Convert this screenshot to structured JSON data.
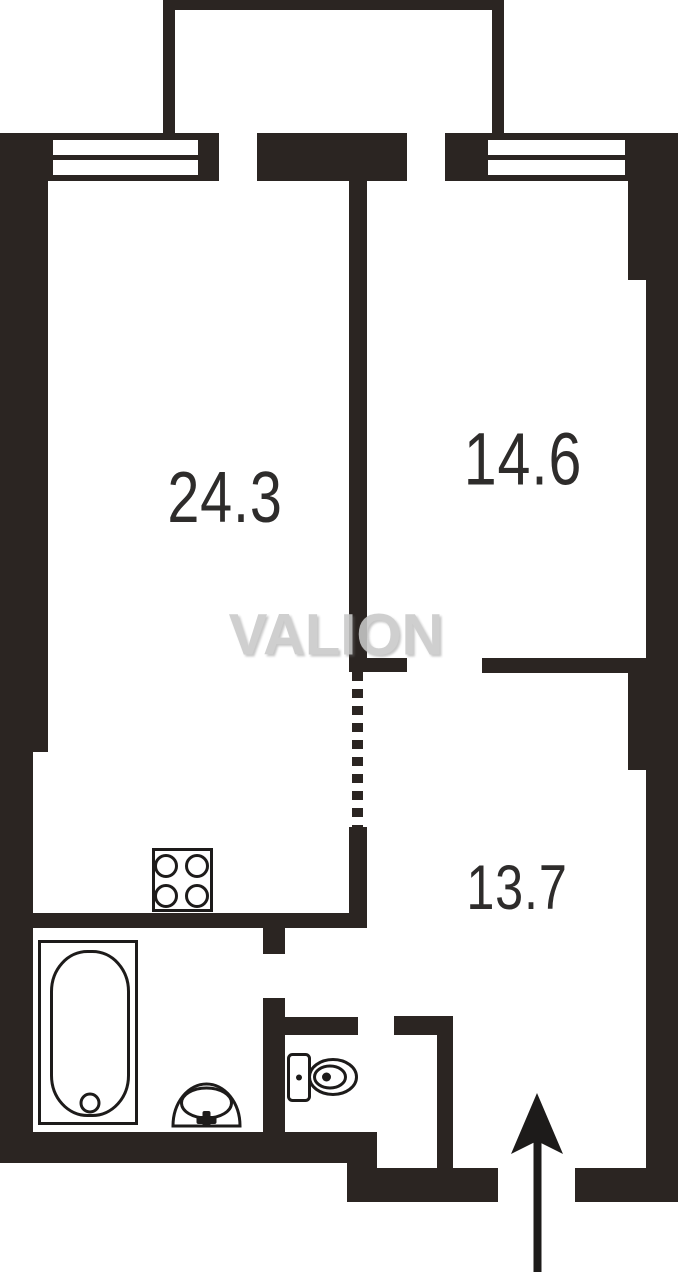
{
  "watermark": {
    "text": "VALION"
  },
  "rooms": [
    {
      "name": "living-room",
      "area": "24.3"
    },
    {
      "name": "bedroom",
      "area": "14.6"
    },
    {
      "name": "hall",
      "area": "13.7"
    }
  ],
  "fixtures": [
    {
      "name": "stove-icon"
    },
    {
      "name": "bathtub-icon"
    },
    {
      "name": "sink-icon"
    },
    {
      "name": "toilet-icon"
    },
    {
      "name": "entrance-arrow-icon"
    }
  ],
  "features": {
    "windows": [
      "window-left",
      "window-right"
    ],
    "balcony": "balcony-outline",
    "dashed_opening": "dashed-opening"
  },
  "colors": {
    "wall": "#2b2522",
    "line": "#1d1b1a",
    "label": "#2e2c2b",
    "watermark": "#c9c9c9",
    "bg": "#ffffff"
  }
}
